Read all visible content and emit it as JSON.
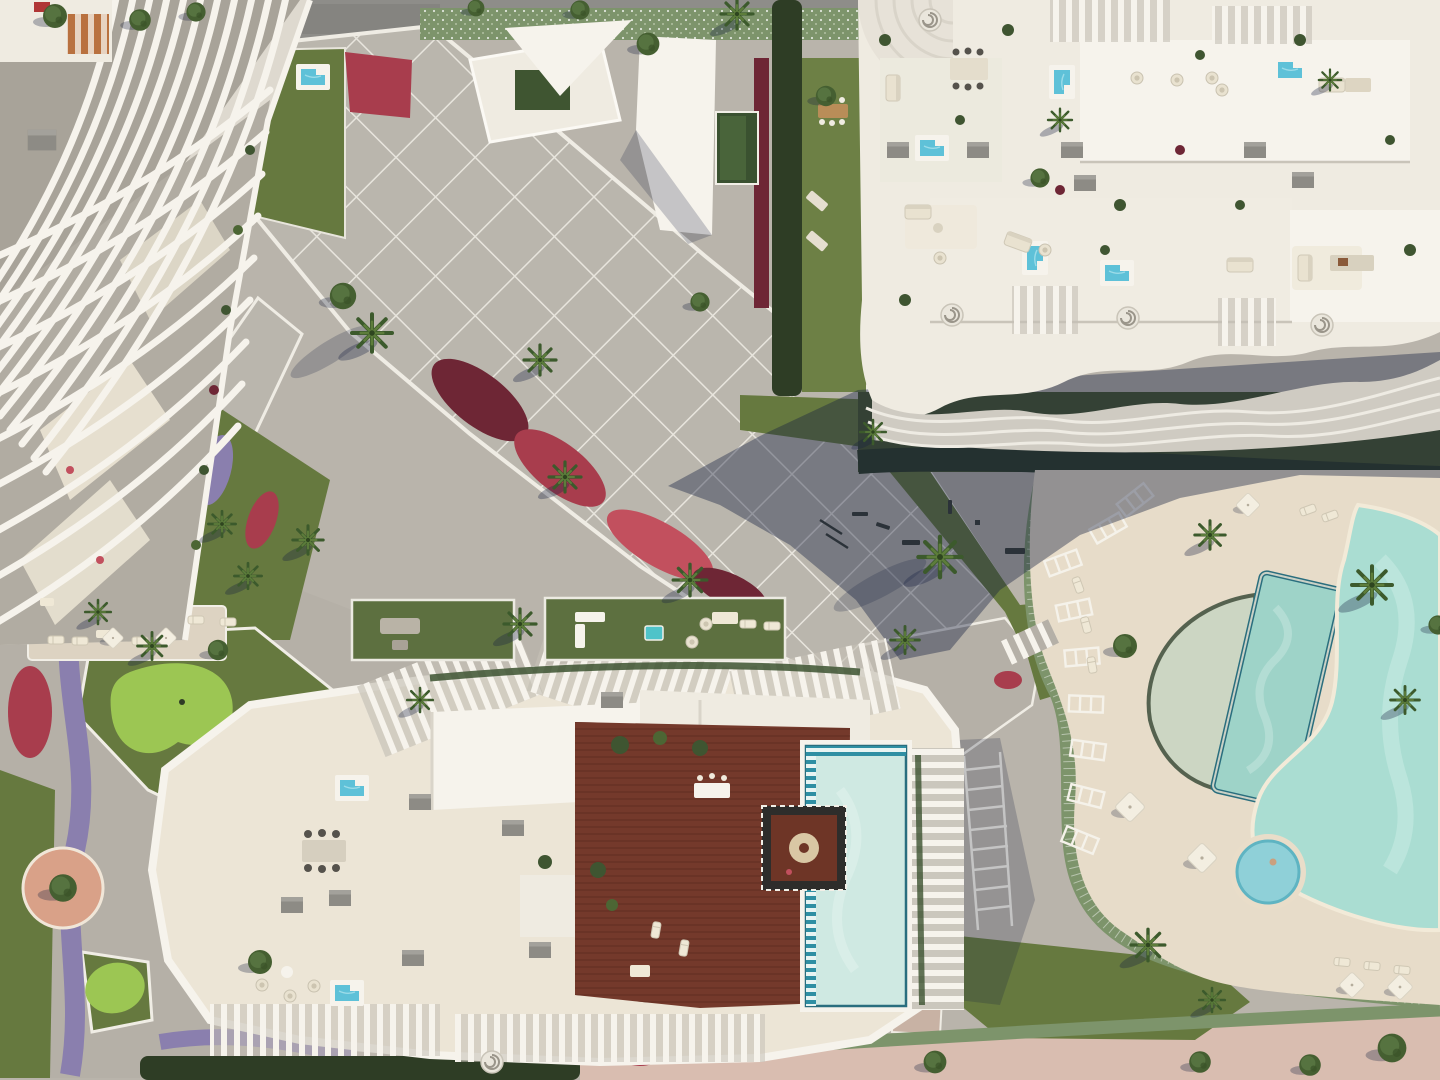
{
  "meta": {
    "description": "Top-down aerial 3D rendering of a luxury residential resort complex with wavy white apartment buildings, rooftop terraces, plunge pools, a wooden roof deck with large pool, lagoon pool area, lawns, flower beds and palm trees",
    "view": "aerial top-down",
    "visible_text": ""
  },
  "palette": {
    "base": "#b9b4ab",
    "road_top": "#8e8d89",
    "road_pink": "#d9bdb0",
    "plaza": "#bab6ad",
    "plaza_line": "#eae7e0",
    "gravel": "#b5b0a7",
    "path_pink": "#c8b2a4",
    "sand": "#e7dcc9",
    "terrace": "#ece5d6",
    "white": "#f6f3ec",
    "white_dim": "#efebe1",
    "white_shade": "#d9d4c9",
    "fin_gap": "#a8a399",
    "gray_box": "#8d8b85",
    "wood": "#74392b",
    "wood_line": "#5d2a1f",
    "water_pale": "#cfe9e2",
    "water_small": "#5ec1d8",
    "tile_teal": "#2f8fa3",
    "tile_dark": "#2a6e7e",
    "lap_water": "#9ed3c8",
    "lagoon": "#aaddd2",
    "jacuzzi": "#8fd0d8",
    "lawn": "#66793f",
    "lawn_light": "#6d8045",
    "lawn_dark": "#49582e",
    "green_bright": "#9cc653",
    "green_roof": "#5d7040",
    "hedge_dark": "#2e3d25",
    "hedge_light": "#7d946b",
    "pavilion_green": "#3a5130",
    "fl_red": "#a83d4d",
    "fl_maroon": "#6e2635",
    "fl_crimson": "#c2505e",
    "fl_purple": "#8a7fae",
    "fl_amber": "#c08a3e",
    "terracotta": "#d9a188",
    "skin": "#caa07e",
    "shadow": "rgba(22,32,64,0.40)",
    "shadow_soft": "rgba(22,32,64,0.22)"
  },
  "scene": {
    "palms": [
      {
        "x": 737,
        "y": 14,
        "s": 1.0
      },
      {
        "x": 540,
        "y": 360,
        "s": 1.0
      },
      {
        "x": 372,
        "y": 333,
        "s": 1.25
      },
      {
        "x": 565,
        "y": 477,
        "s": 1.0
      },
      {
        "x": 690,
        "y": 580,
        "s": 1.05
      },
      {
        "x": 308,
        "y": 540,
        "s": 0.95
      },
      {
        "x": 248,
        "y": 576,
        "s": 0.85
      },
      {
        "x": 222,
        "y": 524,
        "s": 0.85
      },
      {
        "x": 520,
        "y": 624,
        "s": 1.0
      },
      {
        "x": 940,
        "y": 557,
        "s": 1.35
      },
      {
        "x": 873,
        "y": 432,
        "s": 0.8
      },
      {
        "x": 1210,
        "y": 535,
        "s": 0.95
      },
      {
        "x": 1372,
        "y": 585,
        "s": 1.25
      },
      {
        "x": 1148,
        "y": 945,
        "s": 1.05
      },
      {
        "x": 1212,
        "y": 1000,
        "s": 0.8
      },
      {
        "x": 152,
        "y": 646,
        "s": 0.9
      },
      {
        "x": 98,
        "y": 612,
        "s": 0.8
      },
      {
        "x": 1330,
        "y": 80,
        "s": 0.7
      },
      {
        "x": 420,
        "y": 700,
        "s": 0.8
      },
      {
        "x": 1060,
        "y": 120,
        "s": 0.75
      },
      {
        "x": 905,
        "y": 640,
        "s": 0.9
      },
      {
        "x": 1405,
        "y": 700,
        "s": 0.9
      }
    ],
    "trees": [
      {
        "x": 55,
        "y": 16,
        "s": 1.0
      },
      {
        "x": 140,
        "y": 20,
        "s": 0.9
      },
      {
        "x": 196,
        "y": 12,
        "s": 0.8
      },
      {
        "x": 648,
        "y": 44,
        "s": 0.95
      },
      {
        "x": 343,
        "y": 296,
        "s": 1.1
      },
      {
        "x": 826,
        "y": 96,
        "s": 0.85
      },
      {
        "x": 1040,
        "y": 178,
        "s": 0.8
      },
      {
        "x": 700,
        "y": 302,
        "s": 0.8
      },
      {
        "x": 1125,
        "y": 646,
        "s": 1.0
      },
      {
        "x": 218,
        "y": 650,
        "s": 0.85
      },
      {
        "x": 63,
        "y": 888,
        "s": 1.15
      },
      {
        "x": 260,
        "y": 962,
        "s": 1.0
      },
      {
        "x": 935,
        "y": 1062,
        "s": 0.95
      },
      {
        "x": 1200,
        "y": 1062,
        "s": 0.9
      },
      {
        "x": 1392,
        "y": 1048,
        "s": 1.2
      },
      {
        "x": 580,
        "y": 10,
        "s": 0.8
      },
      {
        "x": 476,
        "y": 8,
        "s": 0.7
      },
      {
        "x": 1310,
        "y": 1065,
        "s": 0.9
      },
      {
        "x": 1438,
        "y": 625,
        "s": 0.8
      }
    ],
    "parasols": [
      {
        "x": 1130,
        "y": 807
      },
      {
        "x": 1202,
        "y": 858
      },
      {
        "x": 1352,
        "y": 985,
        "s": 0.85
      },
      {
        "x": 1400,
        "y": 987,
        "s": 0.85
      },
      {
        "x": 113,
        "y": 638,
        "s": 0.7
      },
      {
        "x": 166,
        "y": 638,
        "s": 0.7
      },
      {
        "x": 1248,
        "y": 505,
        "s": 0.8
      }
    ],
    "loungers": [
      {
        "x": 1078,
        "y": 585,
        "r": 70
      },
      {
        "x": 1086,
        "y": 625,
        "r": 75
      },
      {
        "x": 1092,
        "y": 665,
        "r": 80
      },
      {
        "x": 1308,
        "y": 510,
        "r": -20
      },
      {
        "x": 1330,
        "y": 516,
        "r": -20
      },
      {
        "x": 1342,
        "y": 962,
        "r": 5
      },
      {
        "x": 1372,
        "y": 966,
        "r": 5
      },
      {
        "x": 1402,
        "y": 970,
        "r": 5
      },
      {
        "x": 56,
        "y": 640,
        "r": 0
      },
      {
        "x": 80,
        "y": 641,
        "r": 0
      },
      {
        "x": 140,
        "y": 641,
        "r": 0
      },
      {
        "x": 196,
        "y": 620,
        "r": 0
      },
      {
        "x": 228,
        "y": 622,
        "r": 0
      },
      {
        "x": 656,
        "y": 930,
        "r": 100
      },
      {
        "x": 684,
        "y": 948,
        "r": 100
      },
      {
        "x": 748,
        "y": 624,
        "r": 0
      },
      {
        "x": 772,
        "y": 626,
        "r": 0
      }
    ],
    "garden_pools": [
      {
        "x": 313,
        "y": 77,
        "r": 0
      },
      {
        "x": 955,
        "y": 433,
        "r": 0
      },
      {
        "x": 1086,
        "y": 430,
        "r": 0
      },
      {
        "x": 1168,
        "y": 430,
        "r": 0
      },
      {
        "x": 1262,
        "y": 430,
        "r": 0
      }
    ],
    "roof_pools": [
      {
        "x": 1062,
        "y": 82,
        "r": 90
      },
      {
        "x": 932,
        "y": 148,
        "r": 0
      },
      {
        "x": 1035,
        "y": 258,
        "r": 90
      },
      {
        "x": 1117,
        "y": 273,
        "r": 0
      },
      {
        "x": 1290,
        "y": 70,
        "r": 0
      },
      {
        "x": 352,
        "y": 788,
        "r": 0
      },
      {
        "x": 347,
        "y": 993,
        "r": 0
      }
    ],
    "gray_boxes": [
      {
        "x": 898,
        "y": 150
      },
      {
        "x": 978,
        "y": 150
      },
      {
        "x": 1072,
        "y": 150
      },
      {
        "x": 1255,
        "y": 150
      },
      {
        "x": 1085,
        "y": 183
      },
      {
        "x": 1303,
        "y": 180
      },
      {
        "x": 42,
        "y": 140,
        "s": 1.3
      },
      {
        "x": 420,
        "y": 802
      },
      {
        "x": 413,
        "y": 958
      },
      {
        "x": 540,
        "y": 950
      },
      {
        "x": 513,
        "y": 828
      },
      {
        "x": 292,
        "y": 905
      },
      {
        "x": 340,
        "y": 898
      },
      {
        "x": 612,
        "y": 700
      }
    ],
    "trellises": [
      {
        "x": 1063,
        "y": 563,
        "r": -20
      },
      {
        "x": 1074,
        "y": 610,
        "r": -12
      },
      {
        "x": 1082,
        "y": 657,
        "r": -5
      },
      {
        "x": 1086,
        "y": 704,
        "r": 2
      },
      {
        "x": 1088,
        "y": 750,
        "r": 8
      },
      {
        "x": 1086,
        "y": 796,
        "r": 14
      },
      {
        "x": 1080,
        "y": 840,
        "r": 22
      },
      {
        "x": 1108,
        "y": 528,
        "r": -30
      },
      {
        "x": 1135,
        "y": 500,
        "r": -38
      }
    ],
    "spirals": [
      {
        "x": 930,
        "y": 20
      },
      {
        "x": 952,
        "y": 315
      },
      {
        "x": 1128,
        "y": 318
      },
      {
        "x": 1322,
        "y": 325
      },
      {
        "x": 492,
        "y": 1062
      }
    ],
    "sofas": [
      {
        "x": 893,
        "y": 88,
        "r": 90
      },
      {
        "x": 918,
        "y": 212,
        "r": 0
      },
      {
        "x": 1018,
        "y": 242,
        "r": 20
      },
      {
        "x": 1332,
        "y": 85,
        "r": 0
      },
      {
        "x": 1305,
        "y": 268,
        "r": 90
      },
      {
        "x": 1240,
        "y": 265,
        "r": 0
      }
    ],
    "chairs": [
      {
        "x": 1137,
        "y": 78
      },
      {
        "x": 1177,
        "y": 80
      },
      {
        "x": 1212,
        "y": 78
      },
      {
        "x": 940,
        "y": 258
      },
      {
        "x": 1045,
        "y": 250
      },
      {
        "x": 262,
        "y": 985
      },
      {
        "x": 290,
        "y": 996
      },
      {
        "x": 314,
        "y": 986
      },
      {
        "x": 1222,
        "y": 90
      },
      {
        "x": 692,
        "y": 642
      },
      {
        "x": 706,
        "y": 624
      }
    ]
  }
}
